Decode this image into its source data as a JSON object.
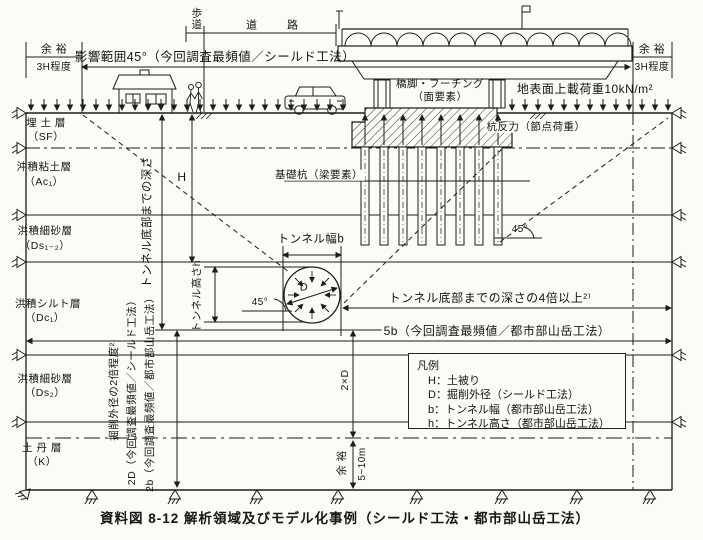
{
  "caption": "資料図 8-12 解析領域及びモデル化事例（シールド工法・都市部山岳工法）",
  "top": {
    "influence_range": "影響範囲45°（今回調査最頻値／シールド工法）",
    "margin_left": {
      "label": "余 裕",
      "value": "3H程度"
    },
    "margin_right": {
      "label": "余 裕",
      "value": "3H程度"
    },
    "sidewalk": "歩道",
    "road": "道路",
    "surcharge": "地表面上載荷重10kN/m²"
  },
  "structure": {
    "pier_line1": "橋脚・フーチング",
    "pier_line2": "（面要素）",
    "pile_reaction": "杭反力（節点荷重）",
    "foundation_pile": "基礎杭（梁要素）"
  },
  "layers": [
    {
      "name": "埋 土 層",
      "code": "（SF）"
    },
    {
      "name": "沖積粘土層",
      "code": "（Ac₁）"
    },
    {
      "name": "洪積細砂層",
      "code": "（Ds₁₋₂）"
    },
    {
      "name": "洪積シルト層",
      "code": "（Dc₁）"
    },
    {
      "name": "洪積細砂層",
      "code": "（Ds₂）"
    },
    {
      "name": "土 丹 層",
      "code": "（K）"
    }
  ],
  "dimensions": {
    "tunnel_bottom_depth": "トンネル底部までの深さ",
    "cover": "H",
    "tunnel_height": "トンネル高さh",
    "tunnel_width": "トンネル幅b",
    "diameter": "D",
    "angle_left": "45°",
    "angle_right": "45°",
    "excavation_2x": "掘削外径の2倍程度²⁾",
    "dim_2D": "2D（今回調査最頻値／シールド工法）",
    "dim_2b": "2b（今回調査最頻値／都市部山岳工法）",
    "two_D": "2×D",
    "bottom_margin": "余 裕",
    "bottom_margin_value": "5~10m",
    "depth_4x": "トンネル底部までの深さの4倍以上²⁾",
    "dim_5b": "5b（今回調査最頻値／都市部山岳工法）"
  },
  "legend": {
    "title": "凡例",
    "items": [
      "H：土被り",
      "D：掘削外径（シールド工法）",
      "b：トンネル幅（都市部山岳工法）",
      "h：トンネル高さ（都市部山岳工法）"
    ]
  }
}
